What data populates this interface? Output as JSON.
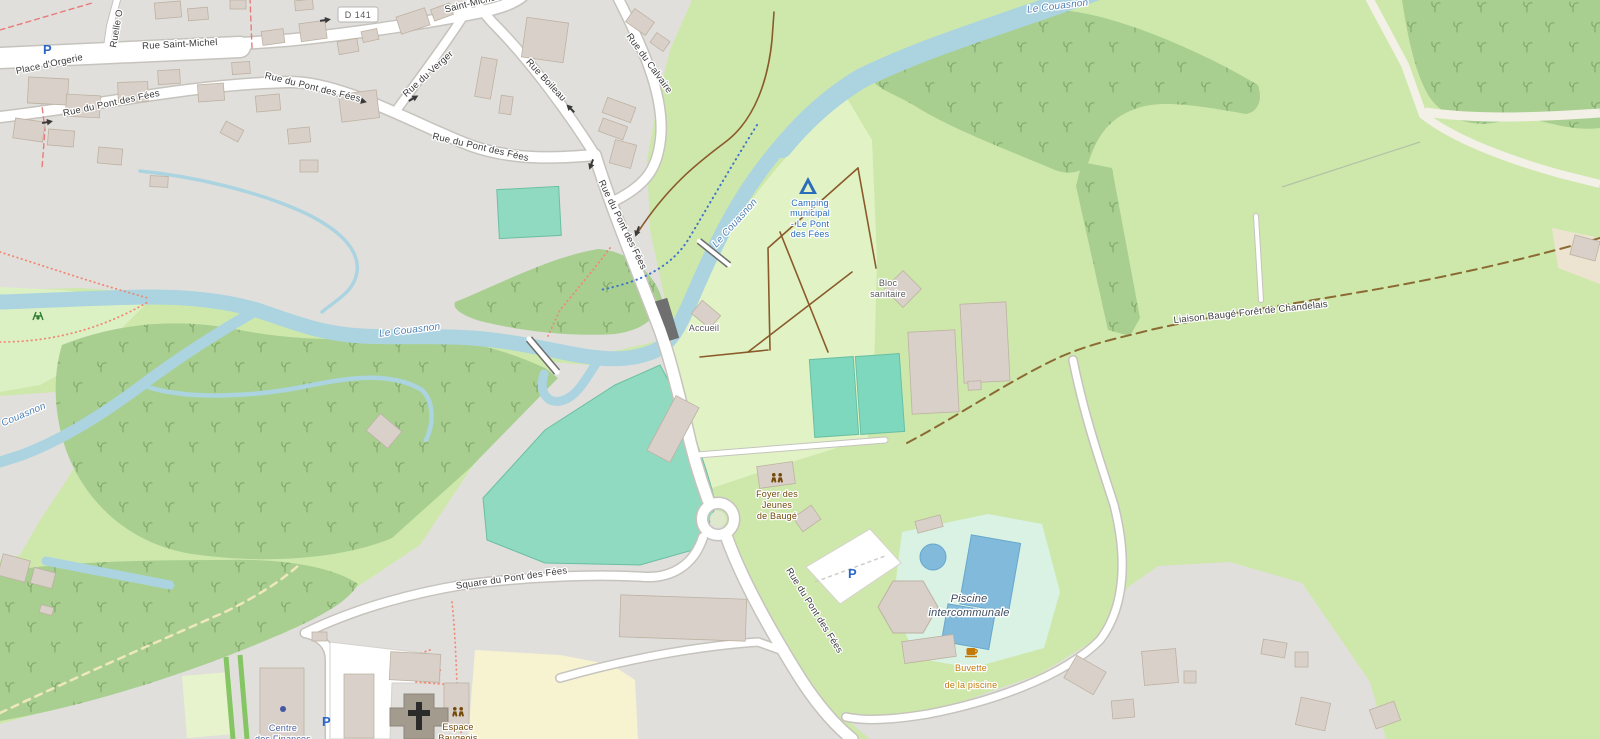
{
  "map": {
    "road_badge": {
      "ref": "D 141"
    },
    "parking_symbol": "P",
    "streets": {
      "rue_saint_michel": "Rue Saint-Michel",
      "saint_michel_top": "Saint-Michel",
      "place_orgerie": "Place d'Orgerie",
      "ruelle_o": "Ruelle O",
      "rue_du_pont_des_fees": "Rue du Pont des Fées",
      "rue_du_verger": "Rue du Verger",
      "rue_boileau": "Rue Boileau",
      "rue_du_calvaire": "Rue du Calvaire",
      "square_du_pont_des_fees": "Square du Pont des Fées"
    },
    "water": {
      "le_couasnon": "Le Couasnon"
    },
    "paths": {
      "liaison": "Liaison Baugé Forêt de Chandelais"
    },
    "pois": {
      "camping": {
        "lines": [
          "Camping",
          "municipal",
          "- Le Pont",
          "des Fées"
        ]
      },
      "accueil": "Accueil",
      "bloc_sanitaire": {
        "lines": [
          "Bloc",
          "sanitaire"
        ]
      },
      "foyer": {
        "lines": [
          "Foyer des",
          "Jeunes",
          "de Baugé"
        ]
      },
      "piscine": {
        "lines": [
          "Piscine",
          "intercommunale"
        ]
      },
      "buvette": {
        "lines": [
          "Buvette",
          "de la piscine"
        ]
      },
      "espace_baugeois": {
        "lines": [
          "Espace",
          "Baugeois"
        ]
      },
      "centre_finances": {
        "lines": [
          "Centre",
          "des Finances"
        ]
      }
    },
    "colors": {
      "field": "#cee8ab",
      "forest": "#a8cf90",
      "residential": "#e1dfdc",
      "camping": "#e1f3c5",
      "park": "#dbf0c3",
      "pitch": "#7ed8bd",
      "pool_surround": "#d9f2e3",
      "pool_water": "#82badb",
      "water": "#abd4e0",
      "school": "#f7f3d0",
      "building": "#d9d0c9",
      "building_outline": "#bdb2a2",
      "road": "#ffffff",
      "road_casing": "#c6c3bd",
      "track_brown": "#8a5a2b",
      "route_dash": "#8b6a34"
    }
  }
}
